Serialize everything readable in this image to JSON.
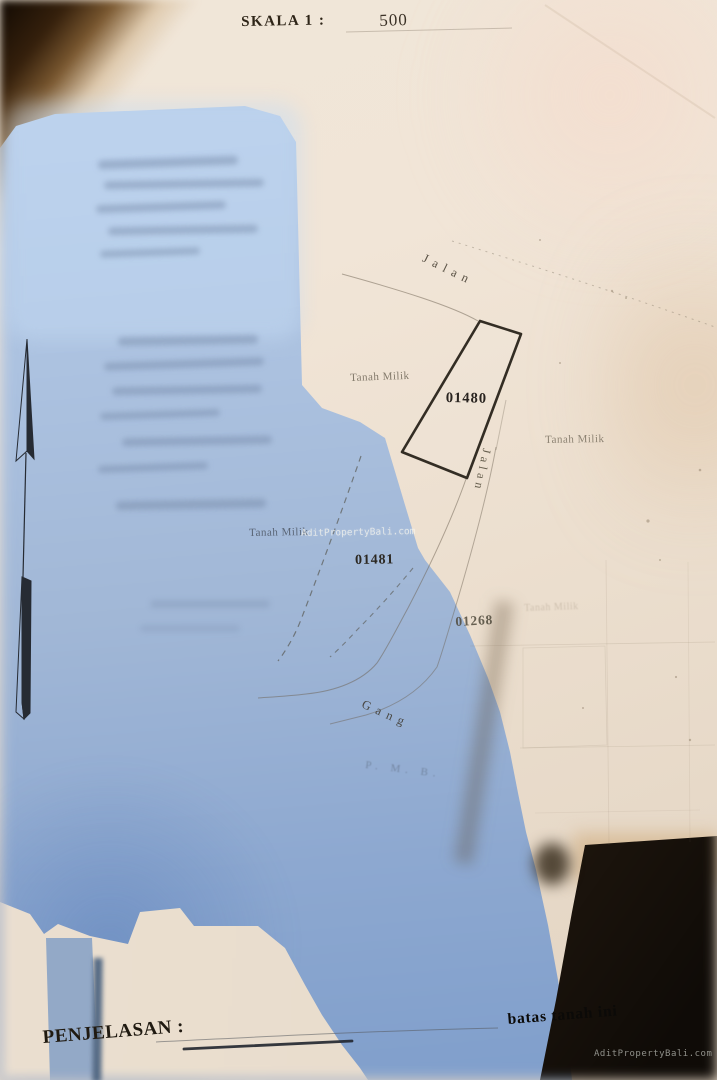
{
  "header": {
    "scale_label": "SKALA 1 :",
    "scale_value": "500"
  },
  "map": {
    "plot_ids": [
      "01480",
      "01481",
      "01268"
    ],
    "road_top": "Jalan",
    "road_side": "Jalan",
    "alley": "Gang",
    "owner_labels": [
      "Tanah Milik",
      "Tanah Milik",
      "Tanah Milik"
    ],
    "ghost_label": "Tanah Milik",
    "faint_note": "P. M. B."
  },
  "footer": {
    "legend_label": "PENJELASAN :",
    "boundary_note": "batas tanah ini"
  },
  "watermarks": {
    "center": "AditPropertyBali.com",
    "corner": "AditPropertyBali.com"
  },
  "colors": {
    "paper": "#f0e6d8",
    "shadow_blue": "#a1b7d6",
    "shadow_brown": "#241a10",
    "ink": "#2f2b23"
  }
}
